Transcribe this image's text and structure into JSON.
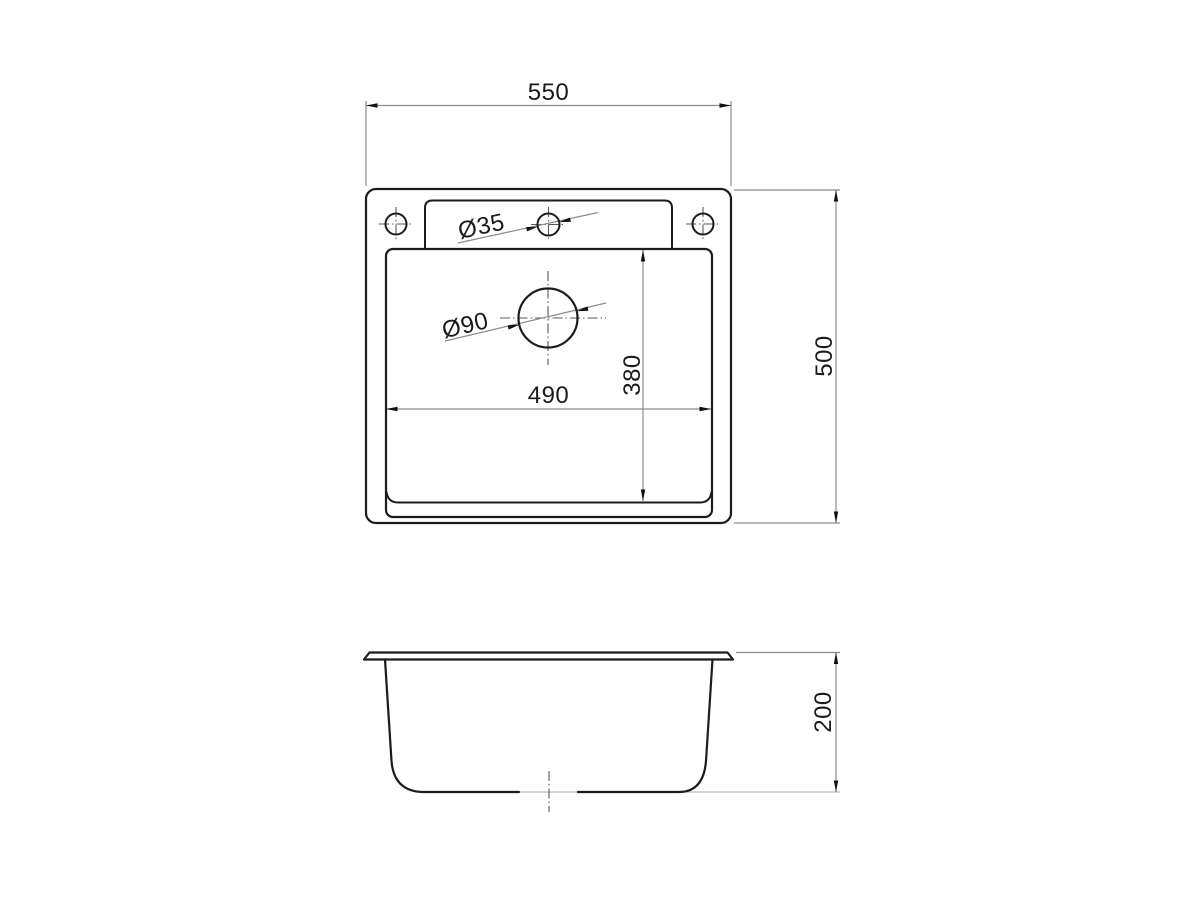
{
  "drawing": {
    "subject": "sink-technical-drawing",
    "background_color": "#ffffff",
    "outline_color": "#1c1c1c",
    "dim_line_color": "#8c8c8c",
    "labels": {
      "overall_width": "550",
      "overall_depth": "500",
      "bowl_width": "490",
      "bowl_depth": "380",
      "faucet_hole_diameter": "Ø35",
      "drain_diameter": "Ø90",
      "bowl_height": "200"
    }
  }
}
